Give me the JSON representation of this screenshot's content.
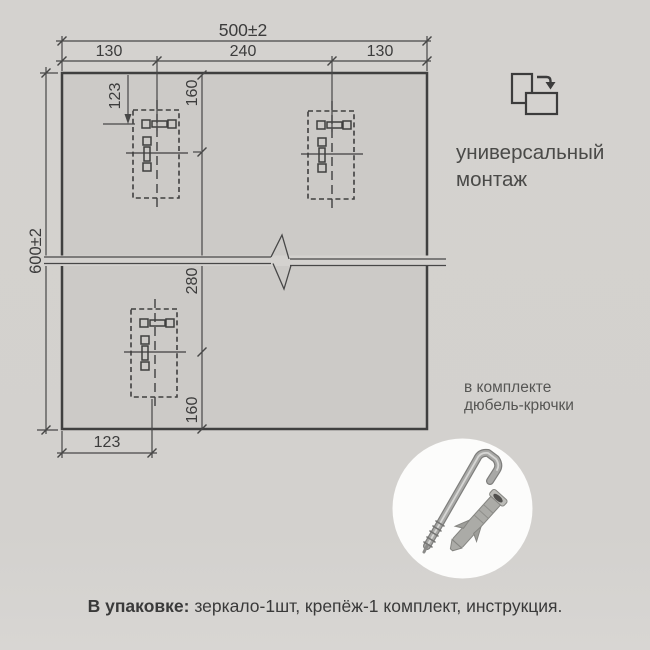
{
  "dimensions": {
    "width_total": "500±2",
    "width_left": "130",
    "width_center": "240",
    "width_right": "130",
    "height_total": "600±2",
    "hook_inset_top": "123",
    "top_to_hook": "160",
    "hook_to_hook": "280",
    "hook_to_bottom": "160",
    "hook_inset_bottom": "123"
  },
  "labels": {
    "universal_line1": "универсальный",
    "universal_line2": "монтаж",
    "kit_line1": "в комплекте",
    "kit_line2": "дюбель-крючки",
    "package_label": "В упаковке:",
    "package_items": " зеркало-1шт, крепёж-1 комплект, инструкция."
  },
  "icons": {
    "orientation": "portrait-to-landscape-rotate-icon",
    "hardware": "hook-and-dowel-photo"
  },
  "colors": {
    "background": "#d4d2cf",
    "mirror_fill": "#cccac7",
    "line": "#474747",
    "border": "#3f3f3f",
    "text": "#3c3c3c",
    "circle_fill": "#fcfcfb"
  }
}
